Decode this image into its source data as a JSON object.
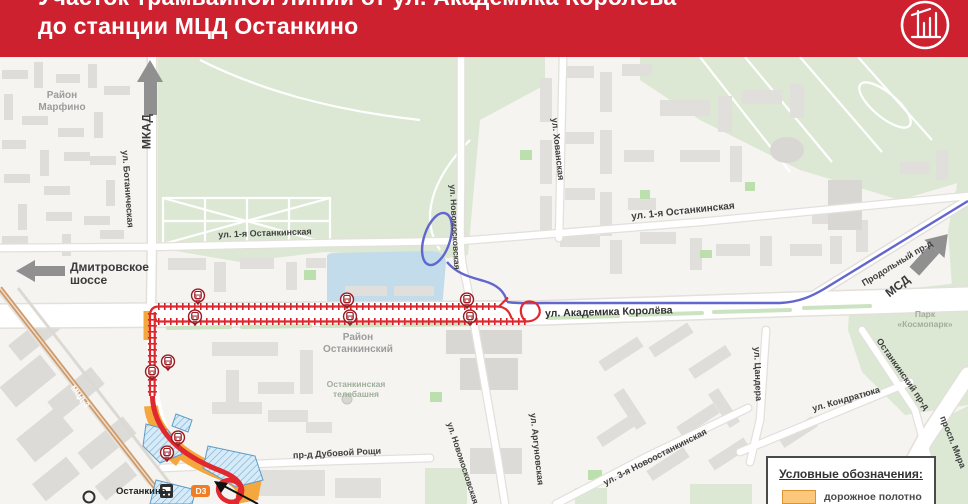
{
  "header": {
    "title_line1": "Участок трамвайной линии от ул. Академика Королёва",
    "title_line2": "до станции МЦД Останкино"
  },
  "map": {
    "districts": {
      "marfino": "Район Марфино",
      "ostankinsky": "Район Останкинский"
    },
    "landmarks": {
      "tv_tower": "Останкинская телебашня",
      "kosmopark": "Парк «Космопарк»"
    },
    "streets": {
      "botanicheskaya": "ул. Ботаническая",
      "ostankinskaya_1": "ул. 1-я Останкинская",
      "khovanskaya": "ул. Хованская",
      "novomoskovskaya": "ул. Новомосковская",
      "koroleva": "ул. Академика Королёва",
      "argunovskaya": "ул. Аргуновская",
      "novoostankinskaya_3": "ул. 3-я Новоостанкинская",
      "tsandera": "ул. Цандера",
      "kondratyuka": "ул. Кондратюка",
      "ostankinsky_proezd": "Останкинский пр-д",
      "prodolny_proezd": "Продольный пр-д",
      "prospekt_mira": "просп. Мира",
      "dubovoy_roshchi": "пр-д Дубовой Рощи"
    },
    "arrows": {
      "mkad": "МКАД",
      "dmitrovskoe": "Дмитровское шоссе",
      "msd": "МСД"
    },
    "station": {
      "name": "Останкино",
      "line_badge": "D3",
      "railway_label": "МЦД-3"
    }
  },
  "legend": {
    "title": "Условные обозначения:",
    "items": [
      {
        "label": "дорожное полотно",
        "swatch": "#FBC87B"
      }
    ]
  },
  "colors": {
    "header_bg": "#CD2130",
    "tram_line": "#DC2328",
    "other_route": "#6266CE",
    "road_surface": "#F3A73D",
    "railway_mcd": "#CE9B6E",
    "construction_zone": "#D6EBF7"
  }
}
